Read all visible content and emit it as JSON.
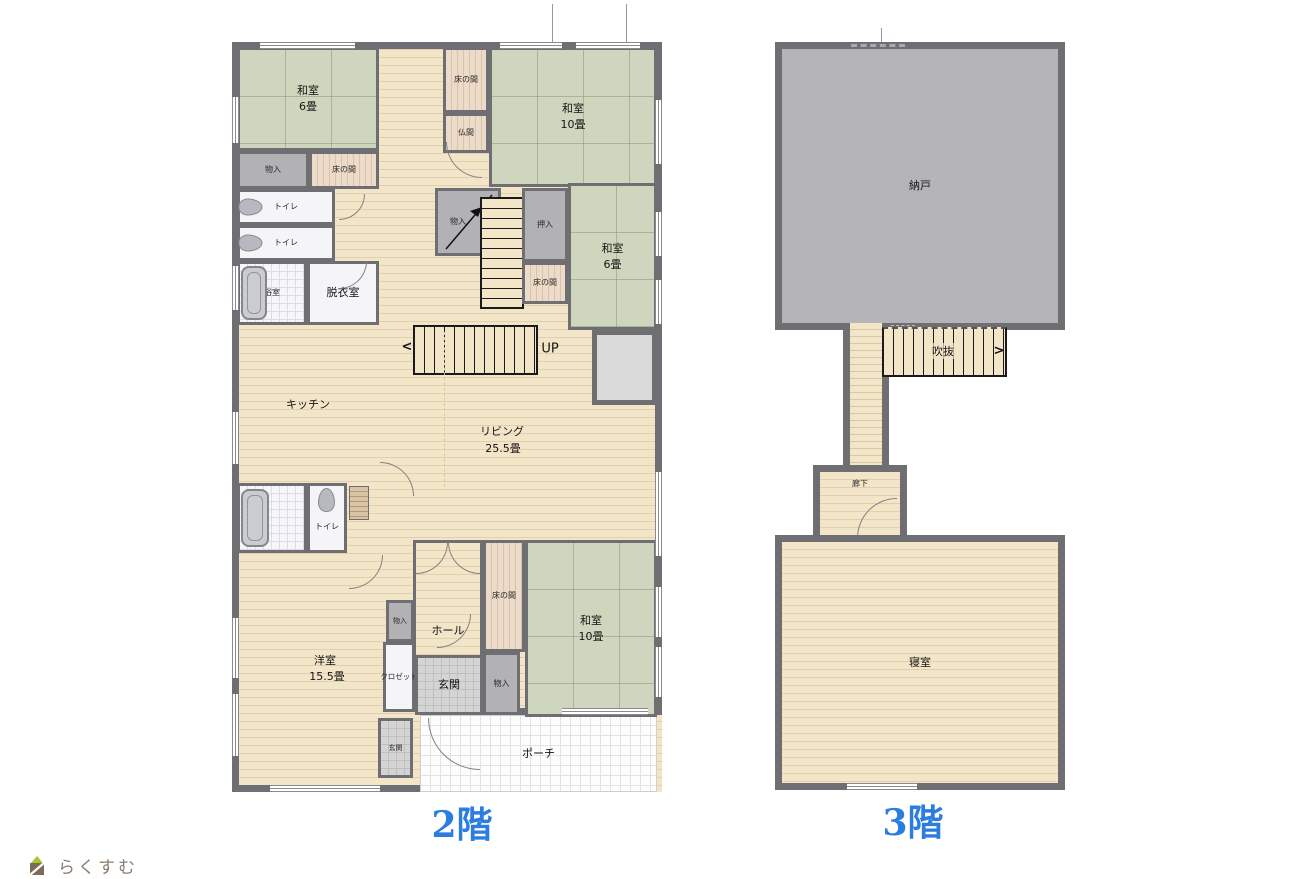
{
  "f2": {
    "title": "2階",
    "washitsu_tl": "和室",
    "washitsu_tl_size": "6畳",
    "storage_tl": "物入",
    "tokonoma_tl": "床の間",
    "toilet1": "トイレ",
    "toilet2": "トイレ",
    "bathroom": "浴室",
    "datsui": "脱衣室",
    "tokonoma_top": "床の間",
    "butsuma": "仏間",
    "washitsu_tr": "和室",
    "washitsu_tr_size": "10畳",
    "storage_c": "物入",
    "oshiire": "押入",
    "tokonoma_mid": "床の間",
    "washitsu_r": "和室",
    "washitsu_r_size": "6畳",
    "up": "UP",
    "up_arrow": "<",
    "kitchen": "キッチン",
    "living": "リビング",
    "living_size": "25.5畳",
    "toilet3": "トイレ",
    "hall": "ホール",
    "tokonoma_b": "床の間",
    "storage_h": "物入",
    "closet": "クロゼット",
    "yoshitsu": "洋室",
    "yoshitsu_size": "15.5畳",
    "genkan": "玄関",
    "storage_g": "物入",
    "washitsu_br": "和室",
    "washitsu_br_size": "10畳",
    "genkan2": "玄関",
    "porch": "ポーチ"
  },
  "f3": {
    "title": "3階",
    "nando": "納戸",
    "fukinuke": "吹抜",
    "fukinuke_arrow": ">",
    "rouka": "廊下",
    "shinshitsu": "寝室"
  },
  "logo": {
    "text": "らくすむ"
  },
  "colors": {
    "accent_blue": "#2b7de0",
    "wall": "#6e6e73",
    "tatami_green": "#ced7bd",
    "wood_beige": "#f3e5c8",
    "storage_gray": "#b2b2b5",
    "nando_gray": "#b5b5b7"
  }
}
